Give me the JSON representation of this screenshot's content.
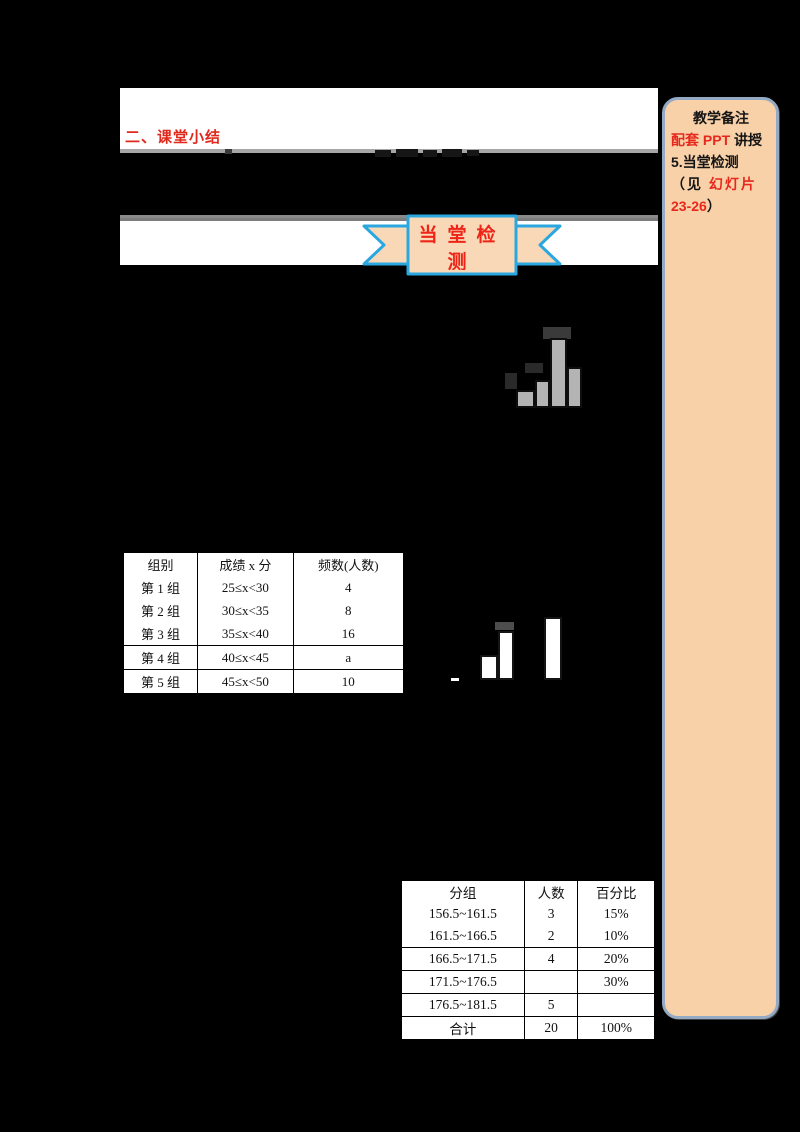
{
  "page": {
    "heading": "二、课堂小结",
    "banner": {
      "title": "当堂检测"
    },
    "sidebar": {
      "title": "教学备注",
      "line1_red": "配套 PPT ",
      "line1_black": "讲授",
      "line2": "5.当堂检测",
      "line3_black": "（见 ",
      "line3_red": "幻灯片",
      "line4_red": "23-26",
      "line4_black": "）"
    },
    "table1": {
      "headers": [
        "组别",
        "成绩 x 分",
        "频数(人数)"
      ],
      "rows": [
        [
          "第 1 组",
          "25≤x<30",
          "4"
        ],
        [
          "第 2 组",
          "30≤x<35",
          "8"
        ],
        [
          "第 3 组",
          "35≤x<40",
          "16"
        ],
        [
          "第 4 组",
          "40≤x<45",
          "a"
        ],
        [
          "第 5 组",
          "45≤x<50",
          "10"
        ]
      ]
    },
    "table2": {
      "headers": [
        "分组",
        "人数",
        "百分比"
      ],
      "rows": [
        [
          "156.5~161.5",
          "3",
          "15%"
        ],
        [
          "161.5~166.5",
          "2",
          "10%"
        ],
        [
          "166.5~171.5",
          "4",
          "20%"
        ],
        [
          "171.5~176.5",
          "",
          "30%"
        ],
        [
          "176.5~181.5",
          "5",
          ""
        ],
        [
          "合计",
          "20",
          "100%"
        ]
      ]
    },
    "chart_data": [
      {
        "type": "bar",
        "description": "partially masked grey histogram fragment",
        "bar_heights_px": [
          18,
          28,
          70,
          41
        ],
        "bar_color": "#b4b4b4"
      },
      {
        "type": "bar",
        "description": "partially masked white histogram fragment",
        "bar_heights_px": [
          25,
          49,
          63
        ],
        "bar_color": "#ffffff"
      }
    ],
    "colors": {
      "accent_red": "#e0291c",
      "ribbon_blue": "#2aa7e0",
      "ribbon_fill": "#f8d8b6",
      "sidebar_fill": "#f8d1a9",
      "sidebar_border": "#94a9c4",
      "bar_gray": "#b4b4b4"
    }
  }
}
